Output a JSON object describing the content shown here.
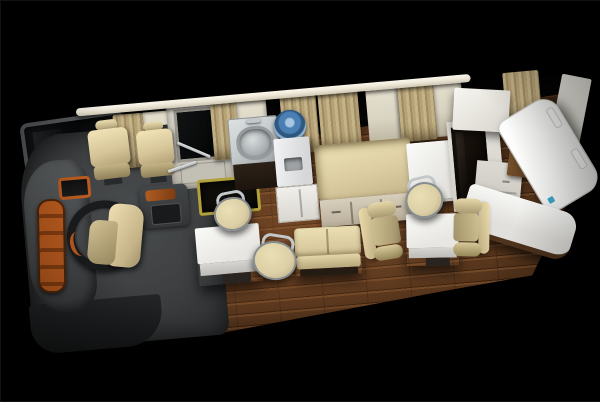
{
  "scene": {
    "type": "3d-render",
    "subject": "motorhome-interior-top-down-cutaway",
    "background_color": "#000000",
    "vehicle_rotation_deg": -5,
    "areas": {
      "cockpit": {
        "label": "driver-cockpit",
        "objects": [
          "windshield",
          "dashboard",
          "dashboard-orange-trim",
          "instrument-cluster",
          "steering-wheel",
          "driver-seat",
          "center-console",
          "passenger-seat-1",
          "passenger-seat-2",
          "cab-floor",
          "front-bumper"
        ]
      },
      "entry": {
        "label": "entry-area",
        "objects": [
          "entry-door",
          "door-window",
          "door-step-well",
          "handrail-upper",
          "handrail-lower",
          "roof-rail"
        ]
      },
      "kitchen": {
        "label": "kitchenette",
        "objects": [
          "sink-counter",
          "sink-basin",
          "faucet",
          "sink-cabinet",
          "water-bottle",
          "water-dispenser",
          "dispenser-cabinet"
        ]
      },
      "lounge": {
        "label": "lounge",
        "objects": [
          "bench-sofa",
          "sofa-drawers",
          "dining-table-1",
          "dining-table-2",
          "stool-1",
          "stool-2",
          "stool-3",
          "lounge-bench",
          "armchair-1",
          "armchair-2",
          "wood-floor"
        ]
      },
      "rear": {
        "label": "rear-galley",
        "objects": [
          "side-counter-cube",
          "overhead-cabinet",
          "tv-cabinet",
          "tv-panel",
          "wardrobe-cabinet",
          "wood-sideboard",
          "refrigerator",
          "rear-wall-panel",
          "rear-counter",
          "counter-accent-chip"
        ]
      },
      "window_wall": {
        "label": "window-wall",
        "objects": [
          "window-band",
          "wall-pillar-1",
          "wall-pillar-2",
          "wall-pillar-3",
          "wall-pillar-4",
          "curtain-1",
          "curtain-2",
          "curtain-3",
          "curtain-4",
          "curtain-5",
          "curtain-6"
        ]
      }
    },
    "palette": {
      "bg": "#000000",
      "rail": "#efe9da",
      "wall-cream": "#d9d3c1",
      "window-black": "#070707",
      "curtain": "#c6b489",
      "curtain-dark": "#a08d63",
      "door-frame": "#cbc8bf",
      "cab-floor": "#3d3f40",
      "dash": "#4b4e50",
      "orange": "#b95a1e",
      "orange-dark": "#823c10",
      "wheel": "#1a1b1d",
      "cream": "#dccfa6",
      "cream-dark": "#b4a57d",
      "white-furn": "#f4f4f2",
      "steel": "#c3c8ca",
      "steel-dark": "#878d8f",
      "wood-light": "#6e4728",
      "wood-mid": "#53331b",
      "wood-dark": "#38200e",
      "step-yellow": "#b0a13c",
      "blue": "#4b7fb3",
      "blue-dark": "#2e5880"
    }
  }
}
